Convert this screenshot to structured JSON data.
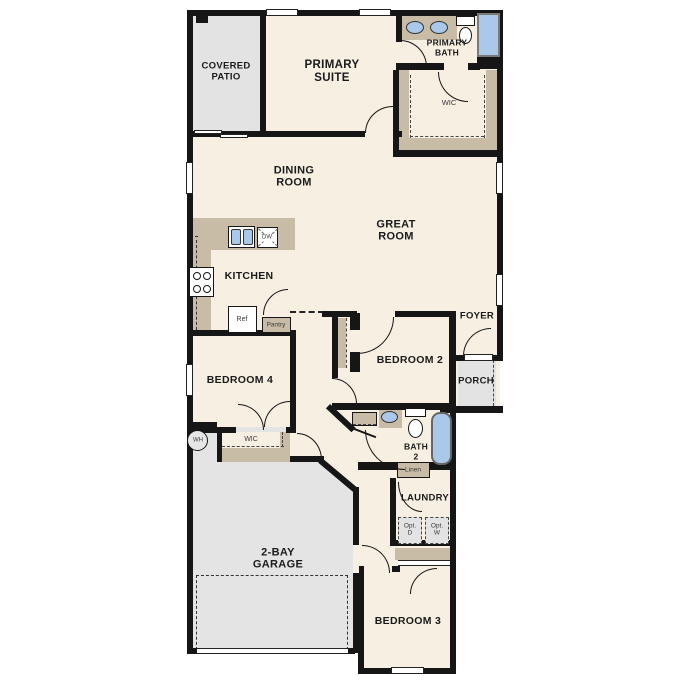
{
  "palette": {
    "floor_cream": "#F6EFE2",
    "exterior_grey": "#E3E3E3",
    "cabinet_tan": "#C9BCA6",
    "wall_black": "#161616",
    "fixture_blue": "#A9C8EA"
  },
  "rooms": [
    {
      "id": "covered-patio",
      "label": "COVERED\nPATIO"
    },
    {
      "id": "primary-suite",
      "label": "PRIMARY\nSUITE"
    },
    {
      "id": "primary-bath",
      "label": "PRIMARY\nBATH"
    },
    {
      "id": "primary-wic",
      "label": "WIC"
    },
    {
      "id": "dining-room",
      "label": "DINING\nROOM"
    },
    {
      "id": "great-room",
      "label": "GREAT\nROOM"
    },
    {
      "id": "kitchen",
      "label": "KITCHEN"
    },
    {
      "id": "bedroom-2",
      "label": "BEDROOM 2"
    },
    {
      "id": "foyer",
      "label": "FOYER"
    },
    {
      "id": "porch",
      "label": "PORCH"
    },
    {
      "id": "bedroom-4",
      "label": "BEDROOM 4"
    },
    {
      "id": "bedroom4-wic",
      "label": "WIC"
    },
    {
      "id": "bath-2",
      "label": "BATH\n2"
    },
    {
      "id": "laundry",
      "label": "LAUNDRY"
    },
    {
      "id": "garage",
      "label": "2-BAY\nGARAGE"
    },
    {
      "id": "bedroom-3",
      "label": "BEDROOM 3"
    }
  ],
  "fixtures": [
    {
      "id": "water-heater",
      "label": "WH"
    },
    {
      "id": "refrigerator",
      "label": "Ref"
    },
    {
      "id": "dishwasher",
      "label": "DW"
    },
    {
      "id": "pantry",
      "label": "Pantry"
    },
    {
      "id": "linen",
      "label": "Linen"
    },
    {
      "id": "optional-dryer",
      "label": "Opt.\nD"
    },
    {
      "id": "optional-washer",
      "label": "Opt.\nW"
    }
  ]
}
